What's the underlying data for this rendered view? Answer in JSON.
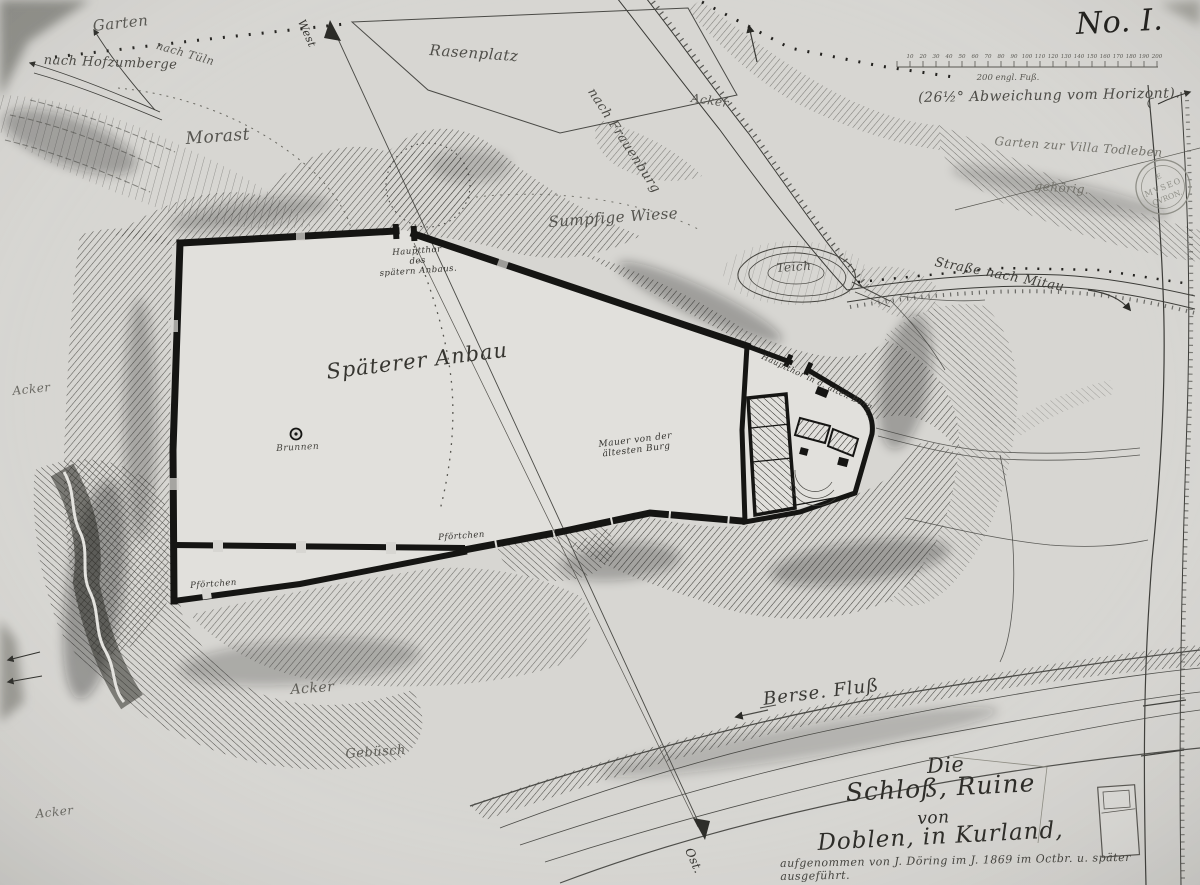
{
  "colors": {
    "paper": "#d7d6d2",
    "ink": "#1d1c1a",
    "faint": "#6e6d66"
  },
  "sheet": {
    "number": "No. I.",
    "declination": "(26½° Abweichung vom Horizont).",
    "scale_caption": "200 engl. Fuß.",
    "scale_ticks": [
      "10",
      "20",
      "30",
      "40",
      "50",
      "60",
      "70",
      "80",
      "90",
      "100",
      "110",
      "120",
      "130",
      "140",
      "150",
      "160",
      "170",
      "180",
      "190",
      "200"
    ]
  },
  "stamp": {
    "line1": "E",
    "line2": "MVSEO",
    "line3": "CVRON."
  },
  "labels": {
    "garten": "Garten",
    "nach_tueln": "nach Tüln",
    "nach_hofzumberge": "nach Hofzumberge",
    "morast": "Morast",
    "rasenplatz": "Rasenplatz",
    "nach_frauenburg": "nach Frauenburg",
    "acker_ne": "Acker",
    "garten_villa": "Garten zur Villa  Todleben",
    "gehoerig": "gehörig.",
    "sumpfige_wiese": "Sumpfige Wiese",
    "teich": "Teich",
    "strasse_mitau": "Straße nach Mitau",
    "west": "West",
    "ost": "Ost.",
    "hauptthor_anbau": "Hauptthor\ndes\nspätern Anbaus.",
    "spaeterer_anbau": "Späterer Anbau",
    "brunnen": "Brunnen",
    "hauptthor_alte_burg": "Hauptthor in d. alten Burg",
    "mauer_aelteste": "Mauer von der\nältesten Burg",
    "pfoertchen_sued": "Pförtchen",
    "pfoertchen_sw": "Pförtchen",
    "acker_west": "Acker",
    "acker_sued": "Acker",
    "gebuesch": "Gebüsch",
    "acker_suedwest": "Acker",
    "berse_fluss": "Berse. Fluß"
  },
  "title": {
    "line1": "Die",
    "line2": "Schloß, Ruine",
    "line3": "von",
    "line4": "Doblen, in Kurland,",
    "credit": "aufgenommen von J. Döring im J. 1869 im Octbr. u. später ausgeführt."
  }
}
